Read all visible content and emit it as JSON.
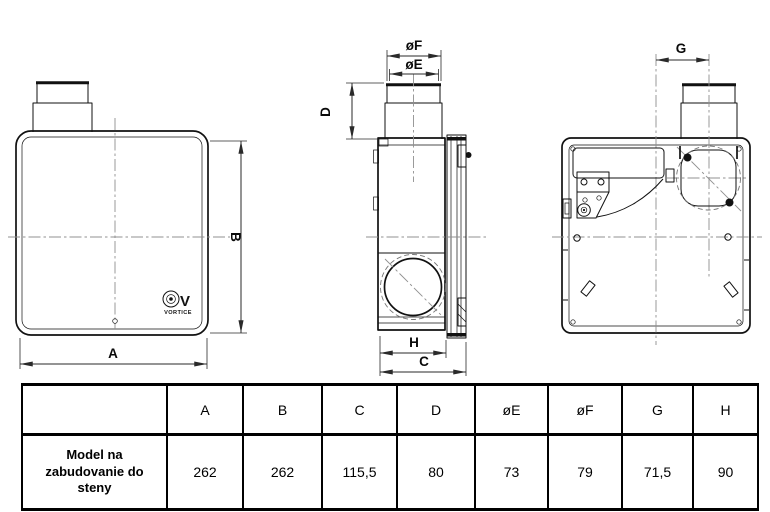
{
  "drawing": {
    "labels": {
      "A": "A",
      "B": "B",
      "C": "C",
      "D": "D",
      "G": "G",
      "H": "H",
      "oE": "øE",
      "oF": "øF"
    },
    "logo": {
      "symbol": "V",
      "brand": "VORTICE"
    }
  },
  "table": {
    "headers": [
      "A",
      "B",
      "C",
      "D",
      "øE",
      "øF",
      "G",
      "H"
    ],
    "rows": [
      {
        "label": "Model na zabudovanie do steny",
        "values": [
          "262",
          "262",
          "115,5",
          "80",
          "73",
          "79",
          "71,5",
          "90"
        ]
      }
    ]
  },
  "colors": {
    "object_line": "#111111",
    "dim_line": "#2a2a2a",
    "center_line": "#909090",
    "table_border": "#000000",
    "background": "#ffffff"
  }
}
